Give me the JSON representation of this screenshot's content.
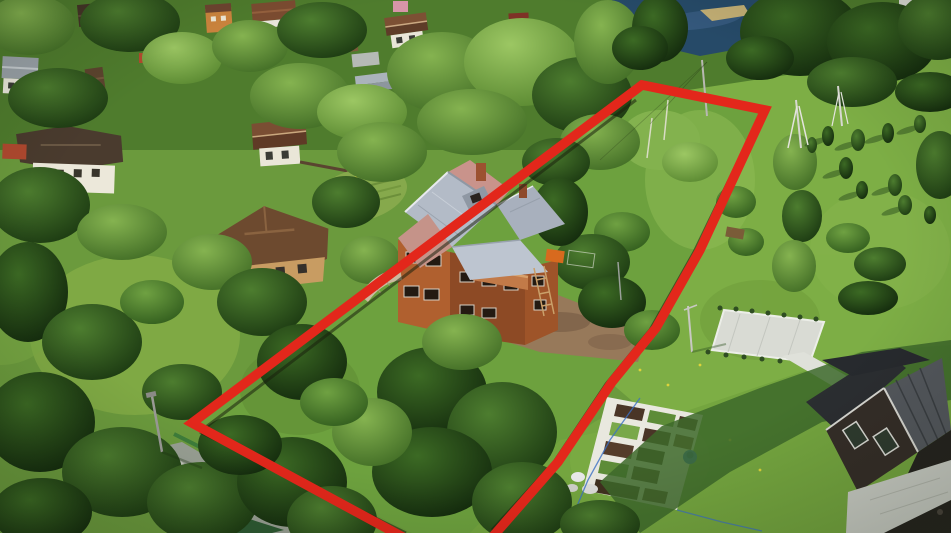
{
  "scene": {
    "kind": "aerial-drone-photo",
    "subject": "suburban land plot outlined in red with a three-story brick house in the center, village houses and pond above, meadow with vegetable garden and dark-roof house at right, forest and access road below-left",
    "boundary": {
      "color": "#e3271b",
      "stroke_width": "9.5",
      "points": "412,542 192,423 642,85 765,110 700,250 656,328 612,382 558,462 488,542"
    },
    "colors": {
      "base_lawn": "#6b9a3d",
      "village_ground": "#4f7c2d",
      "right_meadow": "#7dae45",
      "plot_lawn": "#6da13e",
      "bottom_lawn": "#74a53f",
      "left_lawn": "#7fa944",
      "pond_water": "#264a68",
      "shore_sand": "#c2ae74",
      "road_gray": "#99a094",
      "dirt_yard": "#97795a",
      "brick_wall_sunlit": "#b0602f",
      "brick_wall_shade": "#8d4a25",
      "metal_roof_gray": "#b3bbc7",
      "metal_roof_salmon": "#c59389",
      "dark_house_roof": "#272a2e",
      "dark_house_roof_light": "#54585d",
      "garden_path_white": "#e9e8df",
      "garden_soil": "#4a3527",
      "platform_gray": "#d9dbd4",
      "paved_path": "#c9ccc4",
      "barrel_blue": "#2f6bd4",
      "fence_green": "#3e7d3a",
      "forest_dark": "#1c3a12",
      "forest_mid": "#3c6127",
      "birch_green": "#85b350"
    }
  }
}
